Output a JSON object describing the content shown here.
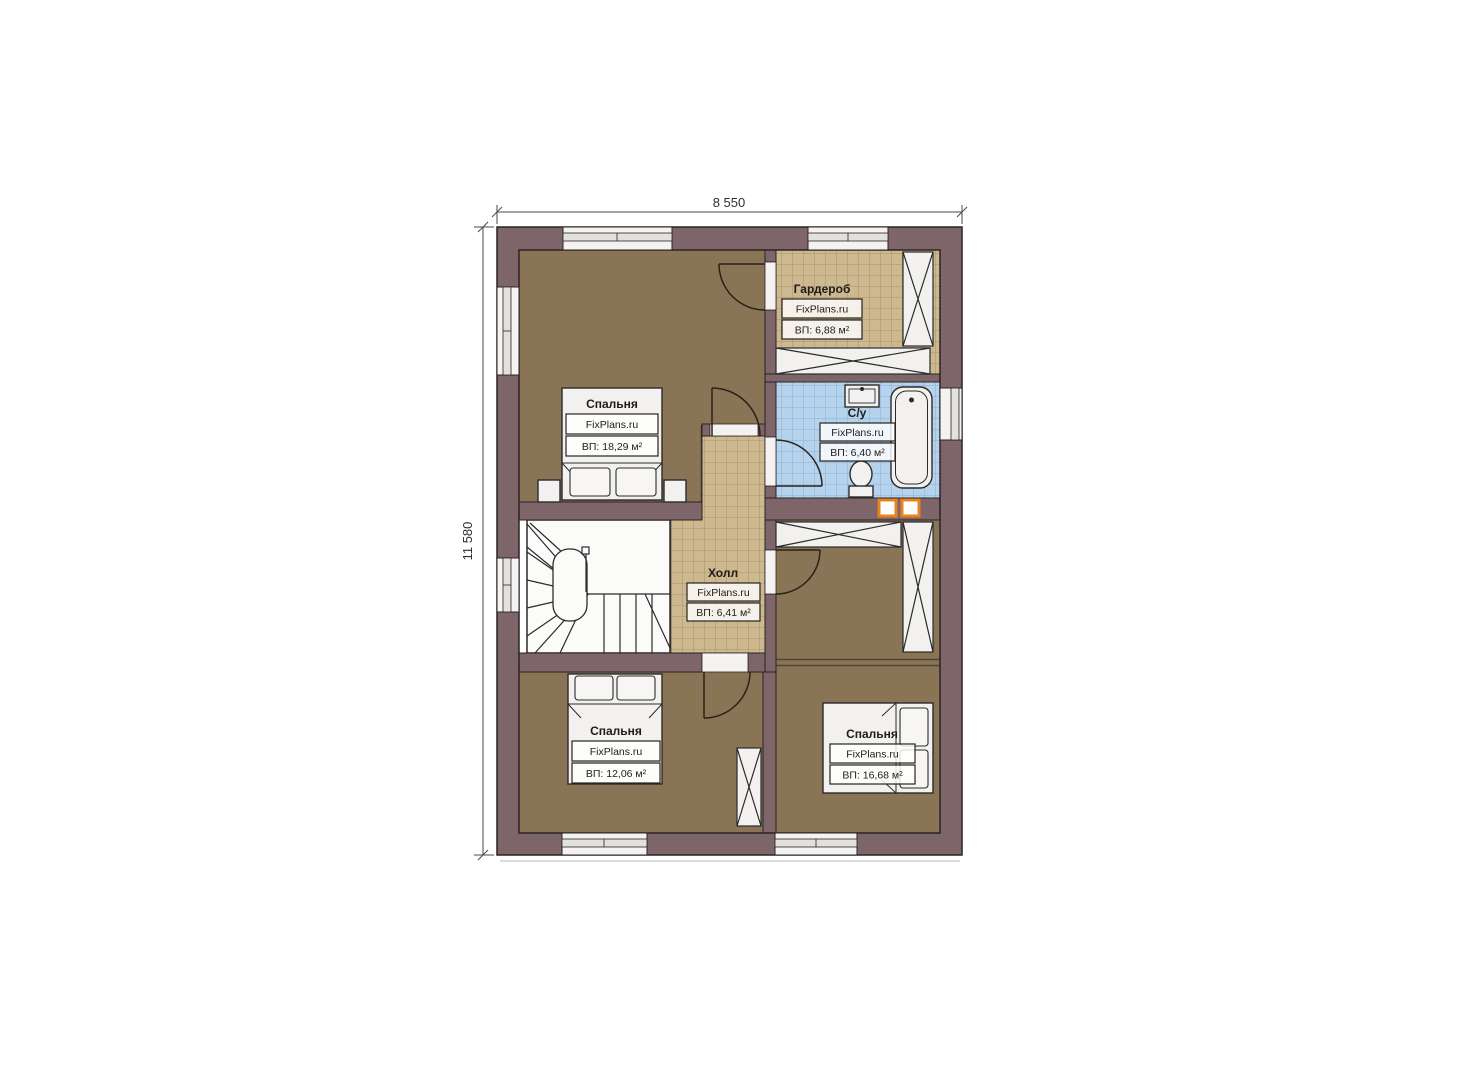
{
  "plan": {
    "dimensions": {
      "width_label": "8 550",
      "height_label": "11 580"
    },
    "colors": {
      "wall": "#7d6569",
      "wood_floor": "#8a7456",
      "tile_tan": "#cdb88f",
      "tile_blue": "#b6d3ed",
      "fixture_white": "#f2f1ef",
      "vent_orange": "#e8831f"
    },
    "rooms": [
      {
        "name": "Спальня",
        "brand": "FixPlans.ru",
        "area": "ВП: 18,29 м²"
      },
      {
        "name": "Гардероб",
        "brand": "FixPlans.ru",
        "area": "ВП: 6,88 м²"
      },
      {
        "name": "С/у",
        "brand": "FixPlans.ru",
        "area": "ВП: 6,40 м²"
      },
      {
        "name": "Холл",
        "brand": "FixPlans.ru",
        "area": "ВП: 6,41 м²"
      },
      {
        "name": "Спальня",
        "brand": "FixPlans.ru",
        "area": "ВП: 12,06 м²"
      },
      {
        "name": "Спальня",
        "brand": "FixPlans.ru",
        "area": "ВП: 16,68 м²"
      }
    ]
  }
}
